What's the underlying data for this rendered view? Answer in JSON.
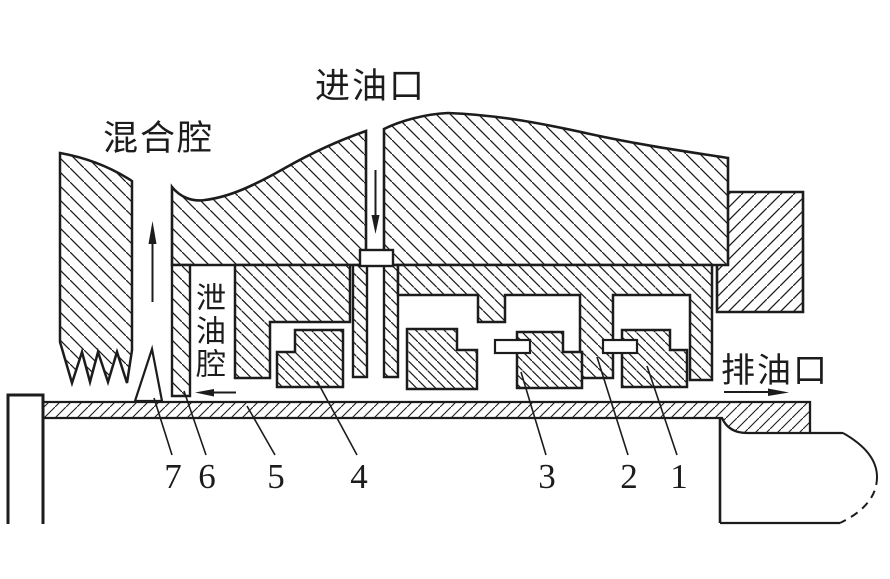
{
  "figure": {
    "type": "engineering-cross-section-diagram",
    "labels": {
      "inlet": "进油口",
      "mixing_chamber": "混合腔",
      "drain_chamber": "泄油腔",
      "outlet": "排油口"
    },
    "part_numbers": [
      "1",
      "2",
      "3",
      "4",
      "5",
      "6",
      "7"
    ],
    "flow_arrows": [
      "inlet-down-arrow",
      "mixing-chamber-up-arrow",
      "drain-left-arrow",
      "outlet-right-arrow"
    ],
    "colors": {
      "line": "#1c1c1c",
      "background": "#ffffff"
    }
  }
}
